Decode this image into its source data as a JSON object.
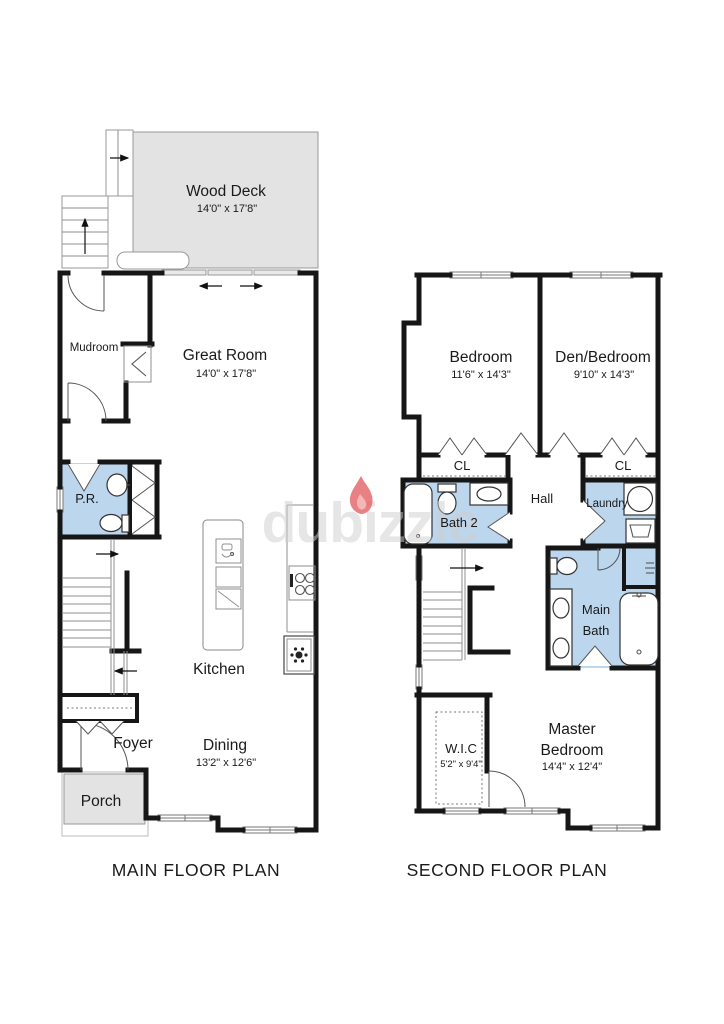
{
  "watermark": {
    "text": "dubizzle"
  },
  "colors": {
    "wall": "#161616",
    "wet_area_fill": "#bcd6ee",
    "deck_fill": "#e3e3e3",
    "watermark_text": "#cfcfcf",
    "flame_red": "#e46064"
  },
  "main_floor": {
    "title": "MAIN FLOOR PLAN",
    "rooms": {
      "wood_deck": {
        "name": "Wood Deck",
        "dims": "14'0\" x 17'8\""
      },
      "mudroom": {
        "name": "Mudroom"
      },
      "great_room": {
        "name": "Great Room",
        "dims": "14'0\" x 17'8\""
      },
      "powder_room": {
        "name": "P.R."
      },
      "kitchen": {
        "name": "Kitchen"
      },
      "dining": {
        "name": "Dining",
        "dims": "13'2\" x 12'6\""
      },
      "foyer": {
        "name": "Foyer"
      },
      "porch": {
        "name": "Porch"
      }
    }
  },
  "second_floor": {
    "title": "SECOND FLOOR PLAN",
    "rooms": {
      "bedroom": {
        "name": "Bedroom",
        "dims": "11'6\" x 14'3\""
      },
      "den_bedroom": {
        "name": "Den/Bedroom",
        "dims": "9'10\" x 14'3\""
      },
      "closet_left": {
        "name": "CL"
      },
      "closet_right": {
        "name": "CL"
      },
      "bath2": {
        "name": "Bath 2"
      },
      "hall": {
        "name": "Hall"
      },
      "laundry": {
        "name": "Laundry"
      },
      "main_bath": {
        "line1": "Main",
        "line2": "Bath"
      },
      "wic": {
        "name": "W.I.C",
        "dims": "5'2\" x 9'4\""
      },
      "master_bedroom": {
        "line1": "Master",
        "line2": "Bedroom",
        "dims": "14'4\" x 12'4\""
      }
    }
  }
}
